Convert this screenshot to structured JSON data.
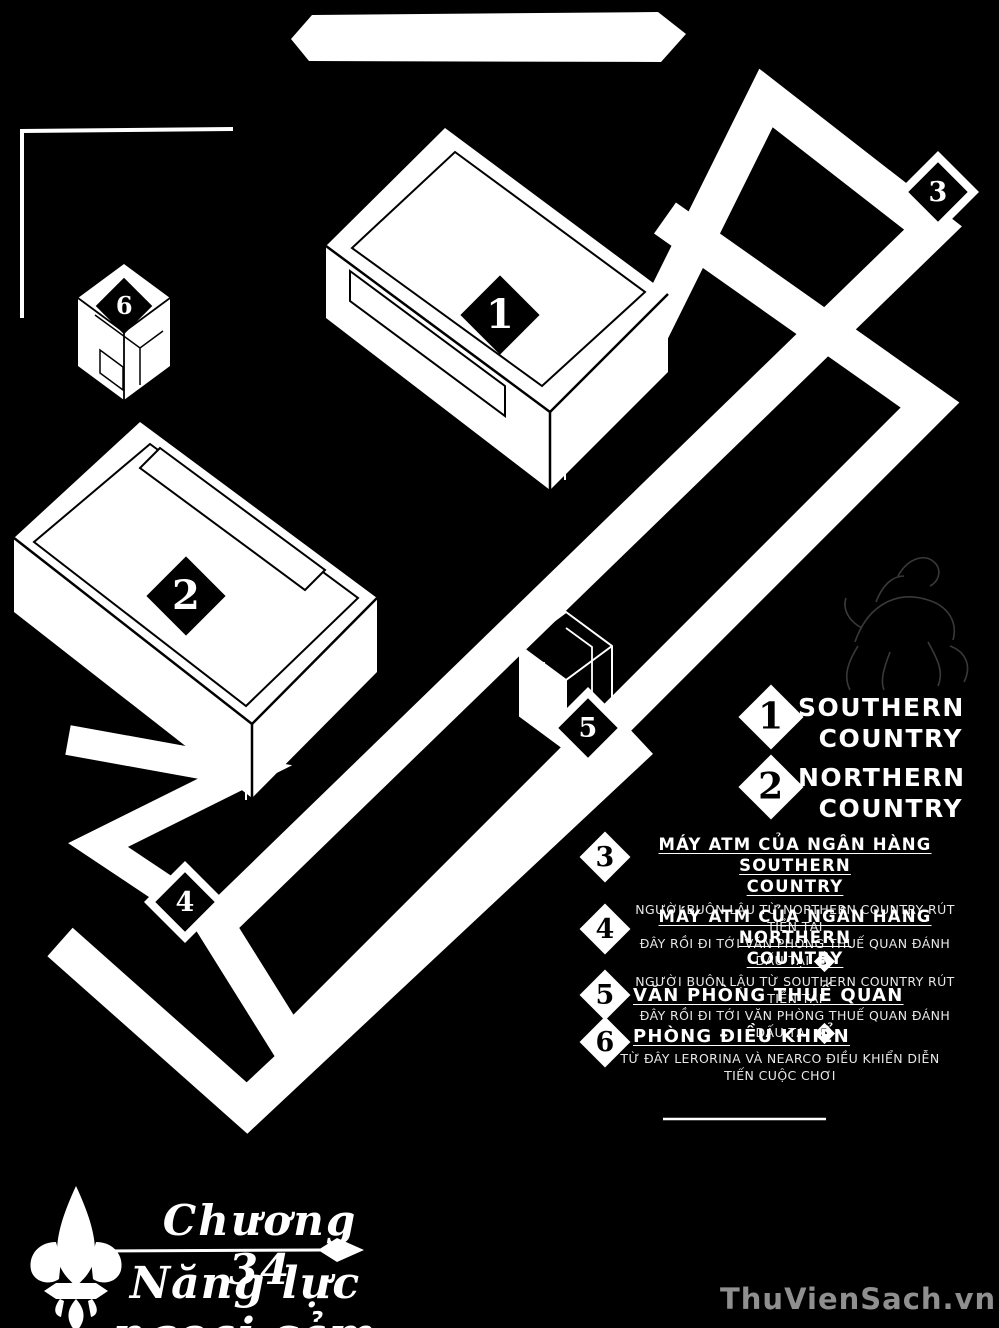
{
  "colors": {
    "background": "#000000",
    "ink": "#ffffff",
    "muted_text": "#e8e8e8",
    "watermark": "#9f9f9f",
    "sketch": "#444444"
  },
  "map": {
    "labels": {
      "b1": "1",
      "b2": "2",
      "m3": "3",
      "m4": "4",
      "m5": "5",
      "m6": "6"
    }
  },
  "legend": {
    "countries": [
      {
        "num": "1",
        "line1": "SOUTHERN",
        "line2": "COUNTRY"
      },
      {
        "num": "2",
        "line1": "NORTHERN",
        "line2": "COUNTRY"
      }
    ],
    "items": [
      {
        "num": "3",
        "heading_line1": "MÁY ATM CỦA NGÂN HÀNG SOUTHERN",
        "heading_line2": "COUNTRY",
        "desc_line1": "NGƯỜI BUÔN LẬU TỪ NORTHERN COUNTRY RÚT TIỀN TẠI",
        "desc_line2": "ĐÂY RỒI ĐI TỚI VĂN PHÒNG THUẾ QUAN ĐÁNH DẤU TẠI",
        "ref": "5"
      },
      {
        "num": "4",
        "heading_line1": "MÁY ATM CỦA NGÂN HÀNG NORTHERN",
        "heading_line2": "COUNTRY",
        "desc_line1": "NGƯỜI BUÔN LẬU TỪ SOUTHERN COUNTRY RÚT TIỀN TẠI",
        "desc_line2": "ĐÂY RỒI ĐI TỚI VĂN PHÒNG THUẾ QUAN ĐÁNH DẤU TẠI",
        "ref": "5"
      },
      {
        "num": "5",
        "heading_line1": "VĂN PHÒNG THUẾ QUAN"
      },
      {
        "num": "6",
        "heading_line1": "PHÒNG ĐIỀU KHIỂN",
        "desc_line1": "TỪ ĐÂY LERORINA VÀ NEARCO ĐIỀU KHIỂN DIỄN",
        "desc_line2": "TIẾN CUỘC CHƠI"
      }
    ]
  },
  "footer": {
    "chapter": "Chương 34",
    "title": "Năng lực ngoại cảm"
  },
  "watermark": "ThuVienSach.vn"
}
